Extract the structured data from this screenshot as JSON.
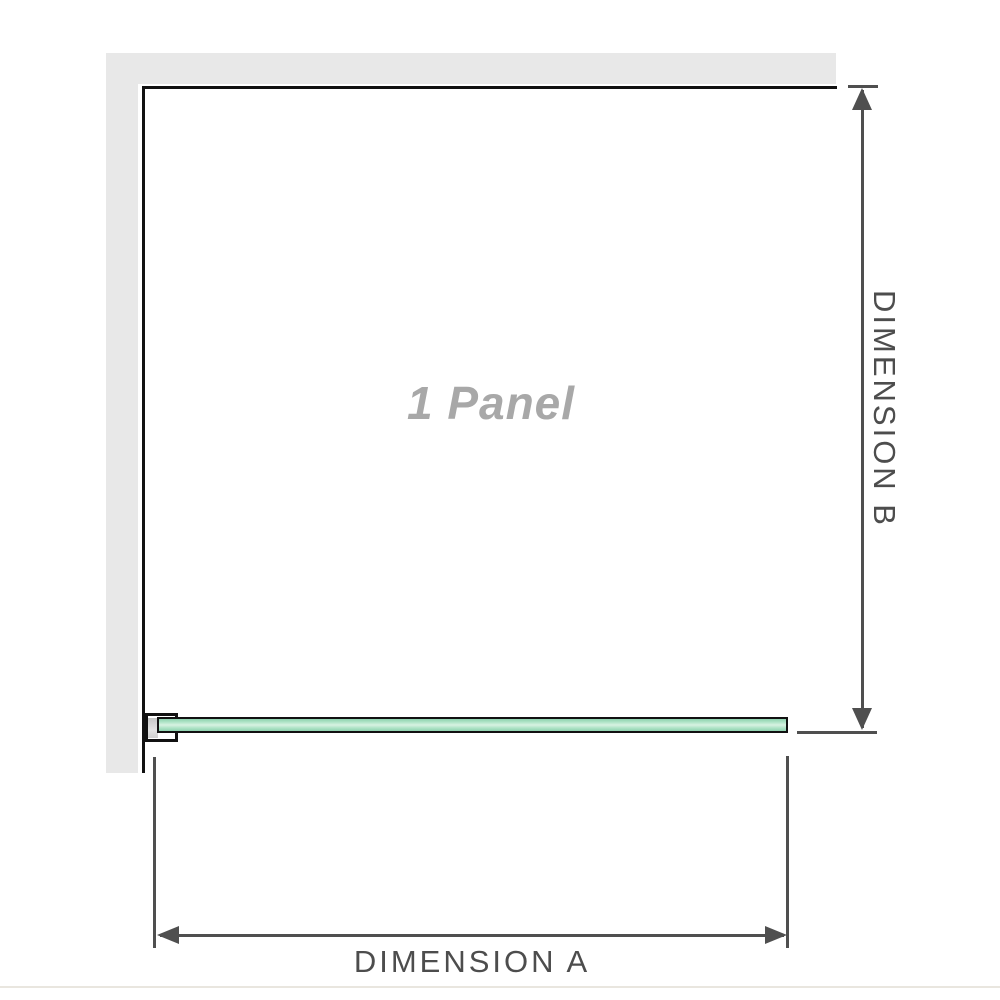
{
  "diagram": {
    "panel_label": "1 Panel",
    "dimension_a_label": "DIMENSION A",
    "dimension_b_label": "DIMENSION B",
    "colors": {
      "wall_gray": "#e8e8e8",
      "outline_black": "#111111",
      "glass_green_light": "#d8f2e2",
      "glass_green_mid": "#aee3c6",
      "glass_green_dark": "#8fd2af",
      "dimension_gray": "#4f4f4f",
      "label_gray": "#4d4d4d",
      "panel_label_gray": "#a8a8a8",
      "divider_beige": "#e9e6df"
    }
  }
}
